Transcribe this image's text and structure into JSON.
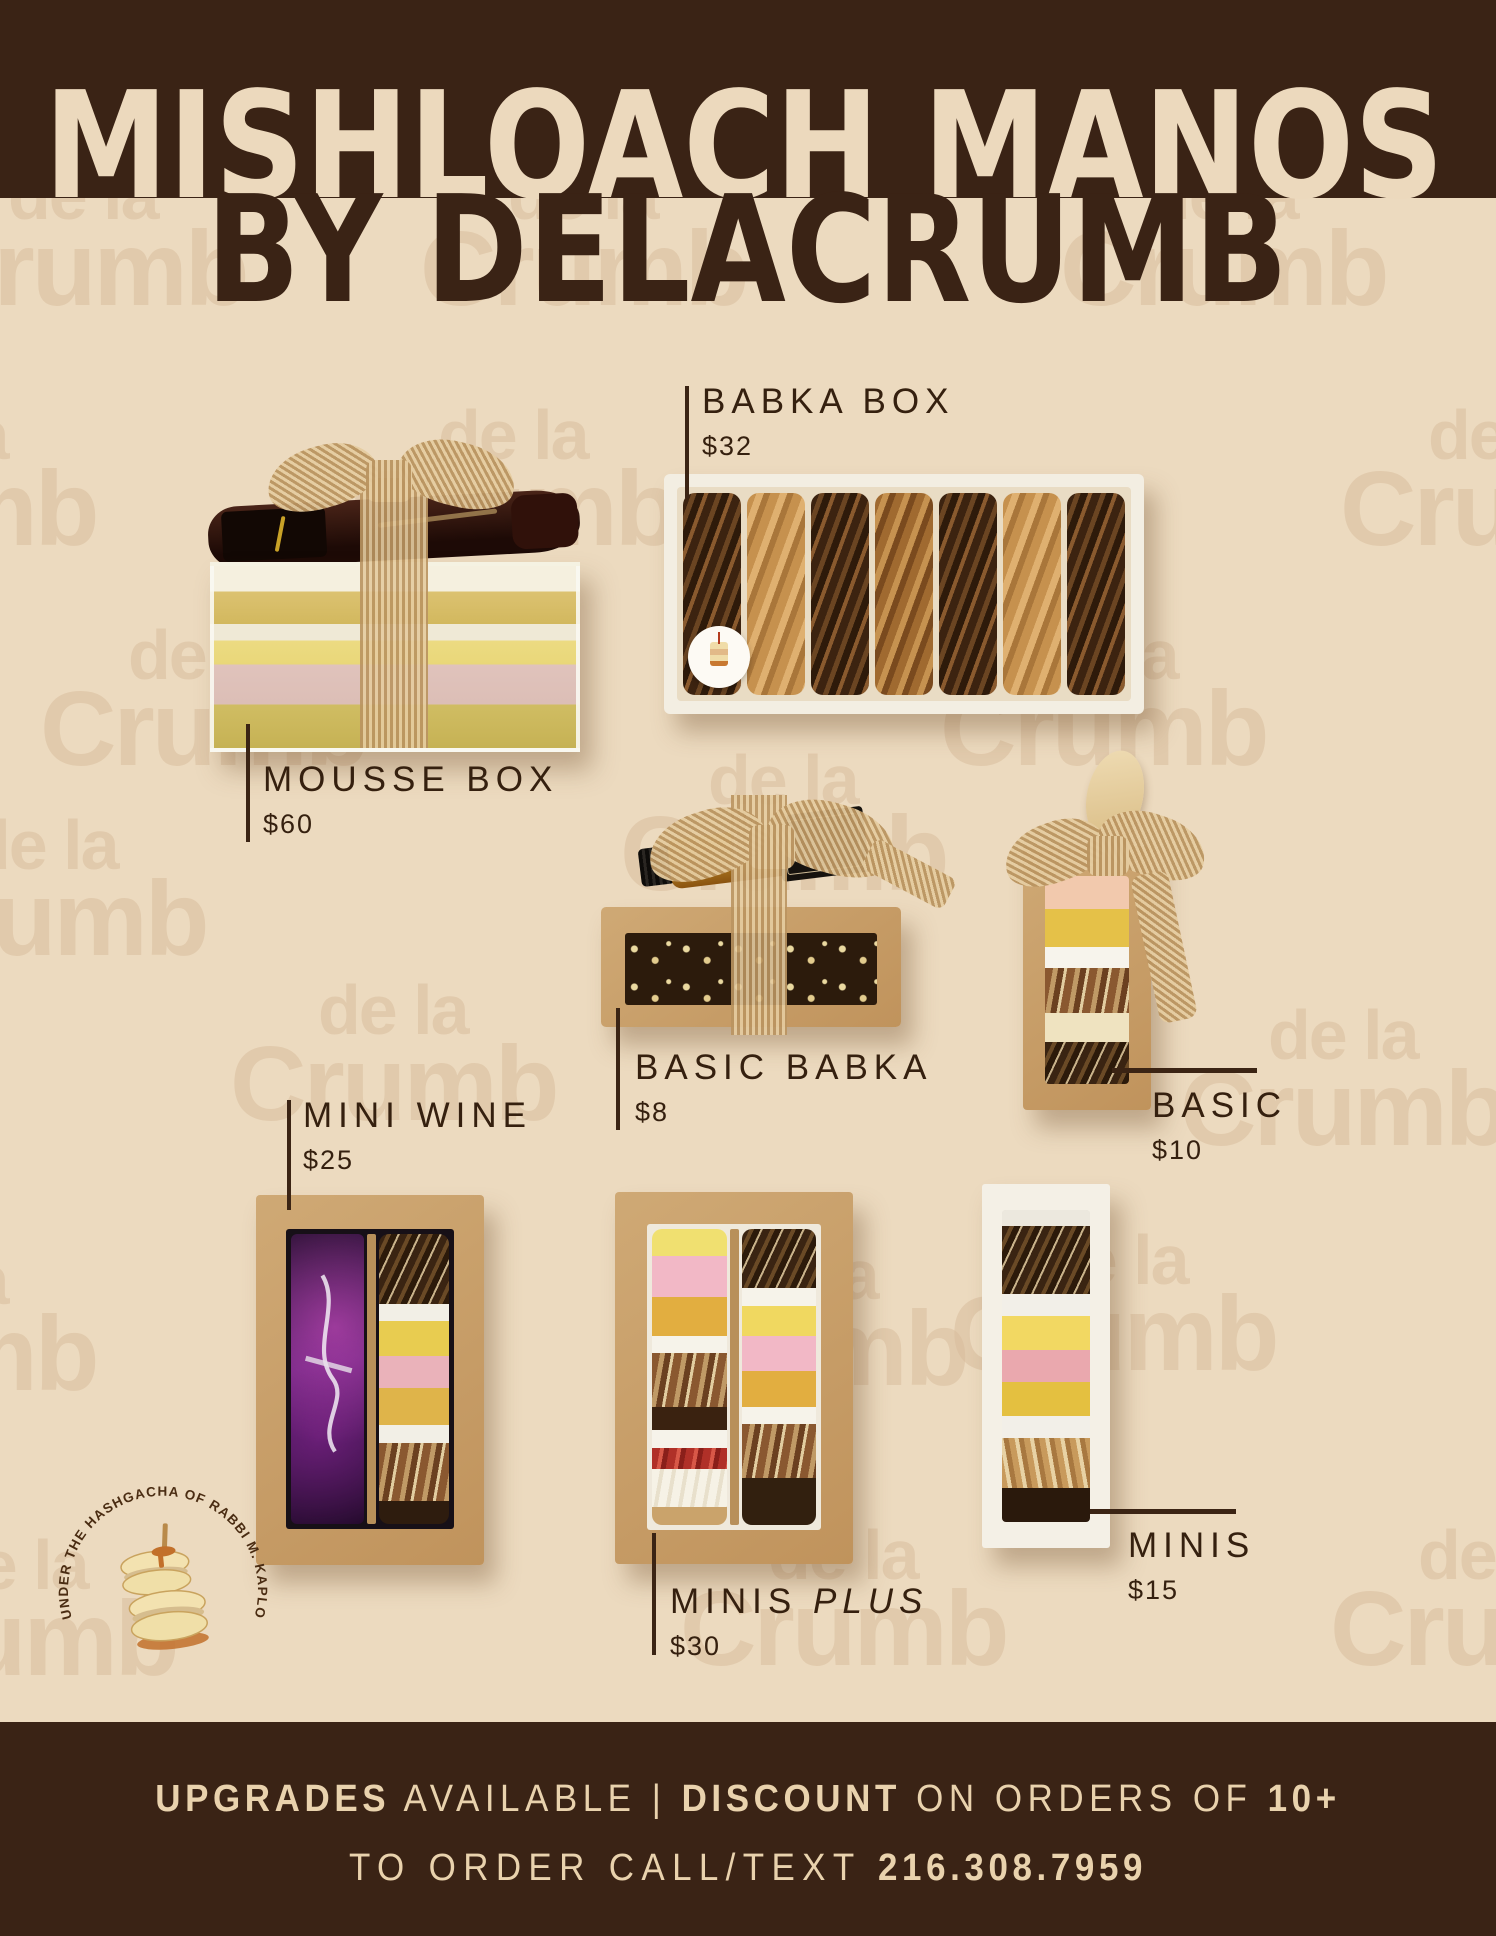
{
  "title": {
    "line1": "MISHLOACH MANOS",
    "line2": "BY DELACRUMB"
  },
  "watermark": {
    "line1": "de la",
    "line2": "Crumb"
  },
  "products": [
    {
      "name": "MOUSSE BOX",
      "price": "$60"
    },
    {
      "name": "BABKA BOX",
      "price": "$32"
    },
    {
      "name": "BASIC BABKA",
      "price": "$8"
    },
    {
      "name": "BASIC",
      "price": "$10"
    },
    {
      "name": "MINI WINE",
      "price": "$25"
    },
    {
      "name": "MINIS",
      "name_suffix": "PLUS",
      "price": "$30"
    },
    {
      "name": "MINIS",
      "price": "$15"
    }
  ],
  "badge": {
    "text": "UNDER THE HASHGACHA OF RABBI M. KAPLOVITZ"
  },
  "footer": {
    "bold1": "UPGRADES",
    "reg1": " AVAILABLE | ",
    "bold2": "DISCOUNT",
    "reg2": " ON ORDERS OF ",
    "bold3": "10+",
    "reg3": "TO ORDER CALL/TEXT ",
    "bold4": "216.308.7959"
  },
  "colors": {
    "banner": "#3a2315",
    "background": "#ecdabf",
    "watermark": "#d9bd9d",
    "label_text": "#35200f",
    "footer_text": "#e9d2ad",
    "kraft": "#c79f66"
  },
  "icons": {
    "badge_center": "macaron-skewer-icon",
    "babka_sticker": "cake-sticker-icon"
  }
}
